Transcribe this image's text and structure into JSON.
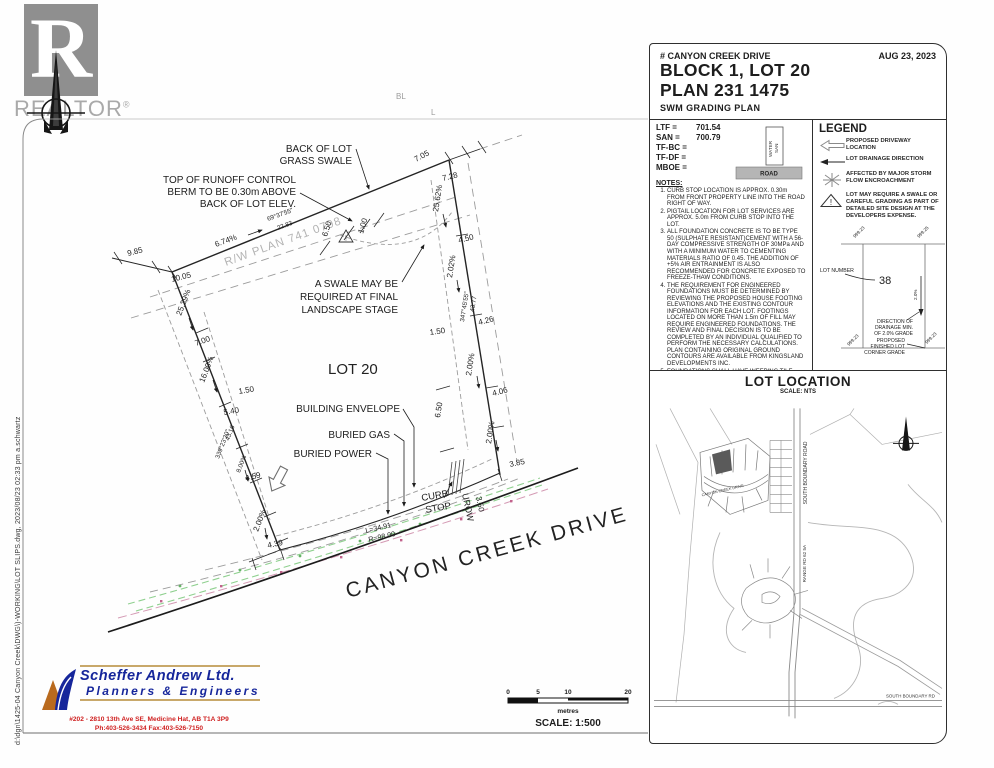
{
  "edge_note": "d:\\dgn\\1425-04 Canyon Creek\\DWG\\)-WORKING\\LOT SLIPS.dwg,  2023/08/23  02:33 pm    a.schwartz",
  "realtor": {
    "word": "REALTOR",
    "reg": "®"
  },
  "title_block": {
    "address": "# CANYON CREEK DRIVE",
    "date": "AUG 23, 2023",
    "block_lot": "BLOCK 1, LOT 20",
    "plan": "PLAN 231 1475",
    "subtitle": "SWM GRADING PLAN"
  },
  "elevations": {
    "rows": [
      {
        "label": "LTF =",
        "value": "701.54"
      },
      {
        "label": "SAN =",
        "value": "700.79"
      },
      {
        "label": "TF-BC =",
        "value": ""
      },
      {
        "label": "TF-DF =",
        "value": ""
      },
      {
        "label": "MBOE =",
        "value": ""
      }
    ],
    "water": "WATER",
    "san": "SAN",
    "road": "ROAD"
  },
  "notes": {
    "heading": "NOTES:",
    "items": [
      "CURB STOP LOCATION IS APPROX. 0.30m FROM FRONT PROPERTY LINE INTO THE ROAD RIGHT OF WAY.",
      "PIGTAIL LOCATION FOR LOT SERVICES ARE APPROX. 5.0m FROM CURB STOP INTO THE LOT.",
      "ALL FOUNDATION CONCRETE IS TO BE TYPE 50 (SULPHATE RESISTANT)CEMENT WITH A 56-DAY COMPRESSIVE STRENGTH OF 30MPa AND WITH A MINIMUM WATER TO CEMENTING MATERIALS RATIO OF 0.45. THE ADDITION OF +5% AIR ENTRAINMENT IS ALSO RECOMMENDED FOR CONCRETE EXPOSED TO FREEZE-THAW CONDITIONS.",
      "THE REQUIREMENT FOR ENGINEERED FOUNDATIONS MUST BE DETERMINED BY REVIEWING THE PROPOSED HOUSE FOOTING ELEVATIONS AND THE EXISTING CONTOUR INFORMATION FOR EACH LOT. FOOTINGS LOCATED ON MORE THAN 1.5m OF FILL MAY REQUIRE ENGINEERED FOUNDATIONS. THE REVIEW AND FINAL DECISION IS TO BE COMPLETED BY AN INDIVIDUAL QUALIFIED TO PERFORM THE NECESSARY CALCULATIONS. PLAN CONTAINING ORIGINAL GROUND CONTOURS ARE AVAILABLE FROM KINGSLAND DEVELOPMENTS INC.",
      "FOUNDATIONS SHALL HAVE WEEPING TILE DRAIN CONNECTED TO THE STORM SEWER SERVICE."
    ],
    "footer": "SANITARY INVERT ELEVATIONS ON THIS PLAN ARE AS-BUILT. ELEVATIONS TAKEN FROM THE PIGTAIL LOCATION APPROX. 5.0m FROM FRONT PROPERTY LINE"
  },
  "legend": {
    "heading": "LEGEND",
    "items": [
      "PROPOSED DRIVEWAY LOCATION",
      "LOT DRAINAGE DIRECTION",
      "AFFECTED BY MAJOR STORM FLOW ENCROACHMENT",
      "LOT MAY REQUIRE A SWALE OR CAREFUL GRADING AS PART OF DETAILED SITE DESIGN AT THE DEVELOPERS EXPENSE."
    ],
    "warning_glyph": "!",
    "sample": {
      "lot_number_label": "LOT NUMBER",
      "lot_number": "38",
      "grade": "2.0%",
      "drainage": [
        "DIRECTION OF",
        "DRAINAGE MIN.",
        "OF 2.0% GRADE"
      ],
      "corner": [
        "PROPOSED",
        "FINISHED LOT",
        "CORNER GRADE"
      ],
      "corners": [
        "999.23",
        "999.25",
        "999.23",
        "999.23"
      ]
    }
  },
  "lot_location": {
    "heading": "LOT LOCATION",
    "scale": "SCALE:  NTS",
    "labels": {
      "sbr_road": "SOUTH BOUNDARY ROAD",
      "range_rd": "RANGE RD 62 5A",
      "ccd": "CANYON CREEK DRIVE",
      "sbr_bottom": "SOUTH BOUNDARY RD"
    }
  },
  "plan": {
    "street": "CANYON CREEK DRIVE",
    "lot": "LOT 20",
    "rw": "R/W PLAN 741 0798",
    "curve": [
      "L=34.91",
      "R=98.00"
    ],
    "curb_stop": [
      "CURB",
      "STOP"
    ],
    "urow": "UROW",
    "fragments": [
      "BL",
      "L"
    ],
    "ann": {
      "back_of_lot": [
        "BACK OF LOT",
        "GRASS SWALE"
      ],
      "berm": [
        "TOP OF RUNOFF CONTROL",
        "BERM TO BE 0.30m ABOVE",
        "BACK OF LOT ELEV."
      ],
      "swale": [
        "A SWALE MAY BE",
        "REQUIRED AT FINAL",
        "LANDSCAPE STAGE"
      ],
      "envelope": "BUILDING ENVELOPE",
      "gas": "BURIED GAS",
      "power": "BURIED POWER"
    },
    "dims": {
      "d_985": "9.85",
      "d_1005": "10.05",
      "pct_674": "6.74%",
      "brg_top": "69°37'55\"",
      "len_top": "22.83",
      "d_705": "7.05",
      "d_728": "7.28",
      "d_650t": "6.50",
      "d_100": "1.00",
      "pct_2562": "25.62%",
      "d_450": "4.50",
      "pct_202": "2.02%",
      "brg_right": "347°45'55\"",
      "len_right": "43.77",
      "d_426": "4.26",
      "d_150r": "1.50",
      "pct_200r": "2.00%",
      "d_406": "4.06",
      "d_650b": "6.50",
      "d_385": "3.85",
      "pct_200f": "2.00%",
      "d_350": "3.50",
      "pct_2529": "25.29%",
      "d_700": "7.00",
      "pct_1600": "16.00%",
      "d_150l": "1.50",
      "d_540": "5.40",
      "len_left": "43.16",
      "brg_left": "339°23'30\"",
      "pct_800": "8.00%",
      "d_459": "4.59",
      "pct_200l": "2.00%",
      "d_439": "4.39"
    }
  },
  "scale_bar": {
    "t0": "0",
    "t5": "5",
    "t10": "10",
    "t20": "20",
    "unit": "metres",
    "label": "SCALE:  1:500"
  },
  "firm": {
    "name": "Scheffer Andrew Ltd.",
    "tagline": "Planners & Engineers",
    "address": "#202 - 2810 13th Ave SE, Medicine Hat, AB  T1A 3P9",
    "phone": "Ph:403-526-3434    Fax:403-526-7150"
  }
}
